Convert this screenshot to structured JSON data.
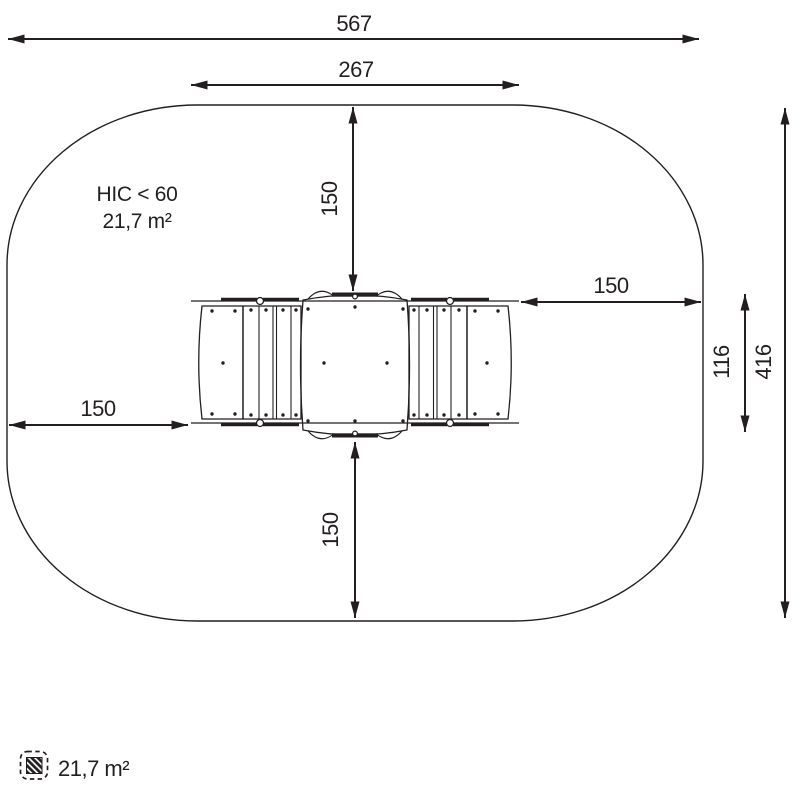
{
  "zone": {
    "hic_label": "HIC < 60",
    "area_label": "21,7 m²"
  },
  "dimensions": {
    "overall_width": "567",
    "device_width": "267",
    "overall_depth": "416",
    "device_depth": "116",
    "clearance_top": "150",
    "clearance_bottom": "150",
    "clearance_left": "150",
    "clearance_right": "150"
  },
  "legend": {
    "icon": "hatched-area-icon",
    "area_label": "21,7 m²"
  },
  "colors": {
    "ink": "#231f20",
    "background": "#ffffff"
  }
}
